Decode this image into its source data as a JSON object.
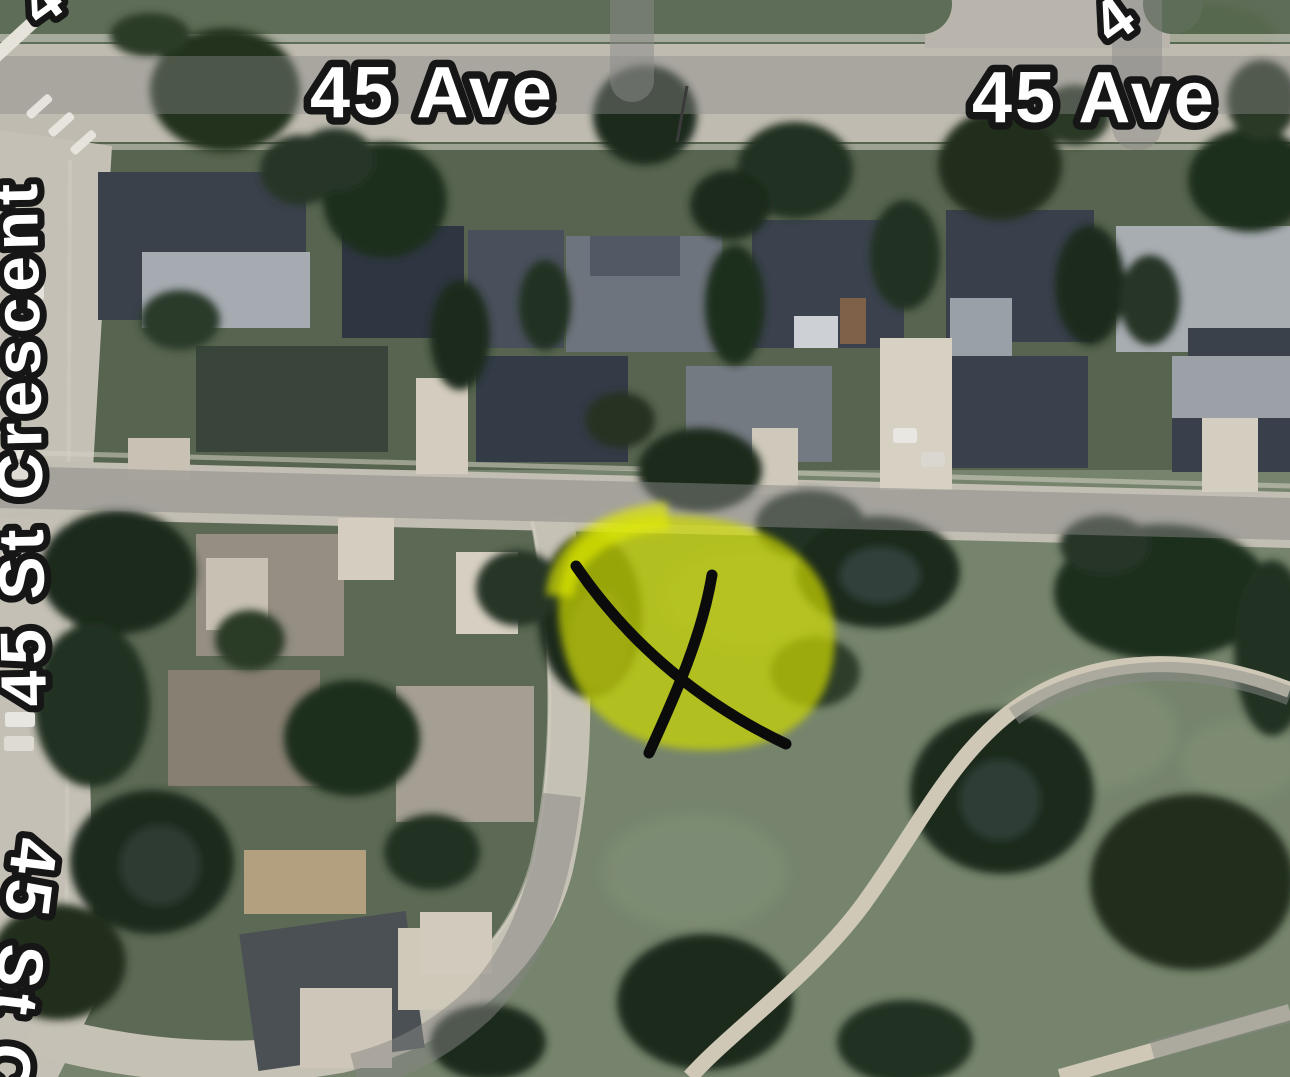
{
  "map": {
    "kind": "satellite-aerial-view",
    "street_labels": {
      "ave_left": "45 Ave",
      "ave_right": "45 Ave",
      "crescent_left": "45 St Crescent",
      "crescent_bottom": "45 St C",
      "corner_top_left": "4",
      "corner_top_right": "4"
    },
    "annotations": {
      "highlight_area": {
        "shape": "irregular-blob",
        "color": "#d2de00",
        "center_x": 695,
        "center_y": 628
      },
      "x_marker": {
        "shape": "hand-drawn-x",
        "color": "#0b0b0b",
        "center_x": 682,
        "center_y": 660
      }
    },
    "palette": {
      "road": "#c3bfb5",
      "road_label_band": "#8a8a88",
      "park_grass": "#76846d",
      "block_grass": "#5c6954",
      "north_band_grass": "#57644f",
      "tree_dark": "#1d2b1c",
      "roof_dark_slate": "#3a414b",
      "roof_light_grey": "#a8adb2",
      "roof_tan": "#b3a07f",
      "driveway": "#d6cfc1",
      "label_fill": "#ffffff",
      "label_outline": "#161616"
    }
  }
}
